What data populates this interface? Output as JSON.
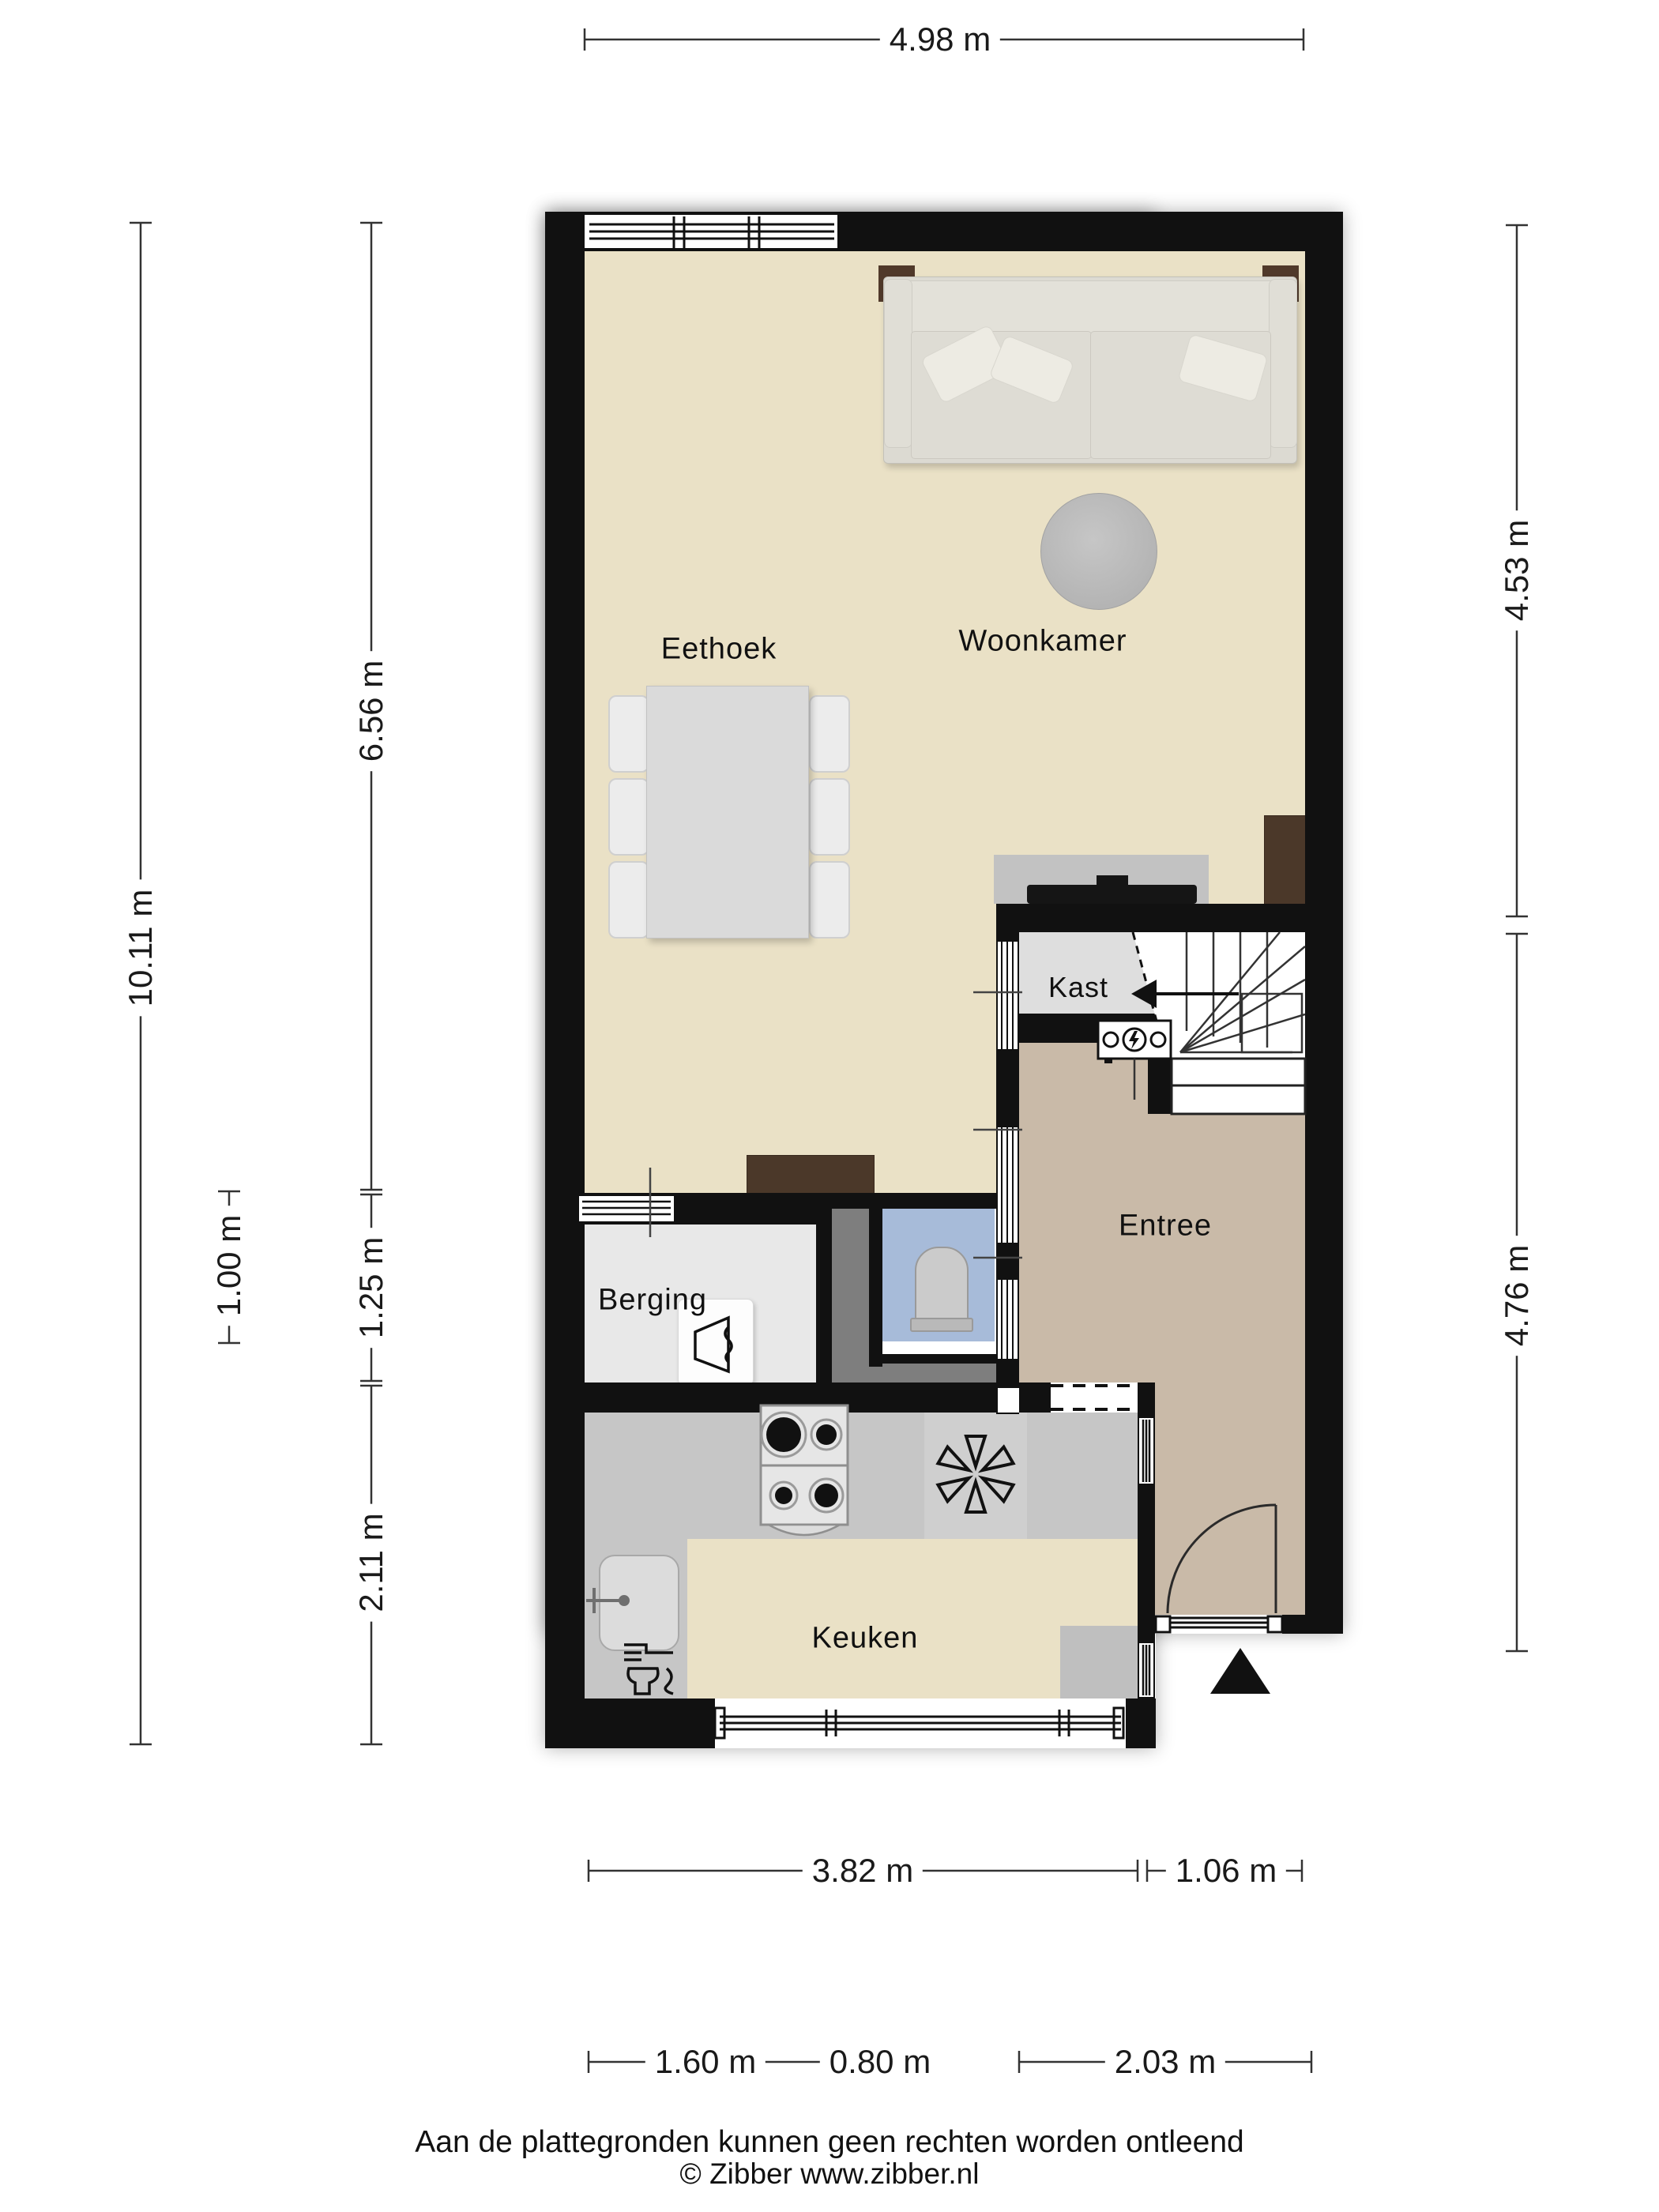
{
  "rooms": {
    "woonkamer": "Woonkamer",
    "eethoek": "Eethoek",
    "kast": "Kast",
    "entree": "Entree",
    "berging": "Berging",
    "keuken": "Keuken"
  },
  "dimensions": {
    "top": "4.98 m",
    "left_total": "10.11 m",
    "left_upper": "6.56 m",
    "left_small": "1.00 m",
    "left_mid": "1.25 m",
    "left_lower": "2.11 m",
    "right_upper": "4.53 m",
    "right_lower": "4.76 m",
    "bottom_row1": [
      "3.82 m",
      "1.06 m"
    ],
    "bottom_row2": [
      "1.60 m",
      "0.80 m",
      "2.03 m"
    ]
  },
  "footer": {
    "disclaimer": "Aan de plattegronden kunnen geen rechten worden ontleend",
    "copyright": "© Zibber www.zibber.nl"
  },
  "colors": {
    "wall": "#111111",
    "floor_living": "#eae1c6",
    "floor_entree": "#c9baa8",
    "floor_kast": "#dedede",
    "floor_berging": "#e8e8e8",
    "floor_hall": "#7e7e7e",
    "floor_toilet": "#a7bbd9",
    "counter": "#c6c6c6",
    "mat": "#bfbfbf",
    "furniture_brown": "#4b3829",
    "sofa": "#dcdad2",
    "table": "#dadada",
    "rug": "#b9b9b9",
    "tv_unit": "#c2c2c2",
    "dimension_text": "#1a1a1a"
  },
  "icons": {
    "stairs_direction_arrow": "left-triangle-arrow",
    "entrance_arrow": "filled-triangle-up",
    "meter_box": "circles-with-lightning-bolt",
    "extractor_fan": "six-blade-fan",
    "gas_hob": "four-burner-hob",
    "sink": "rounded-basin-with-faucet",
    "dishwasher": "plate-and-glass",
    "water_heater": "tank-outline",
    "toilet": "toilet-top-view",
    "front_door": "quarter-circle-swing",
    "tv": "flat-screen-bar"
  }
}
